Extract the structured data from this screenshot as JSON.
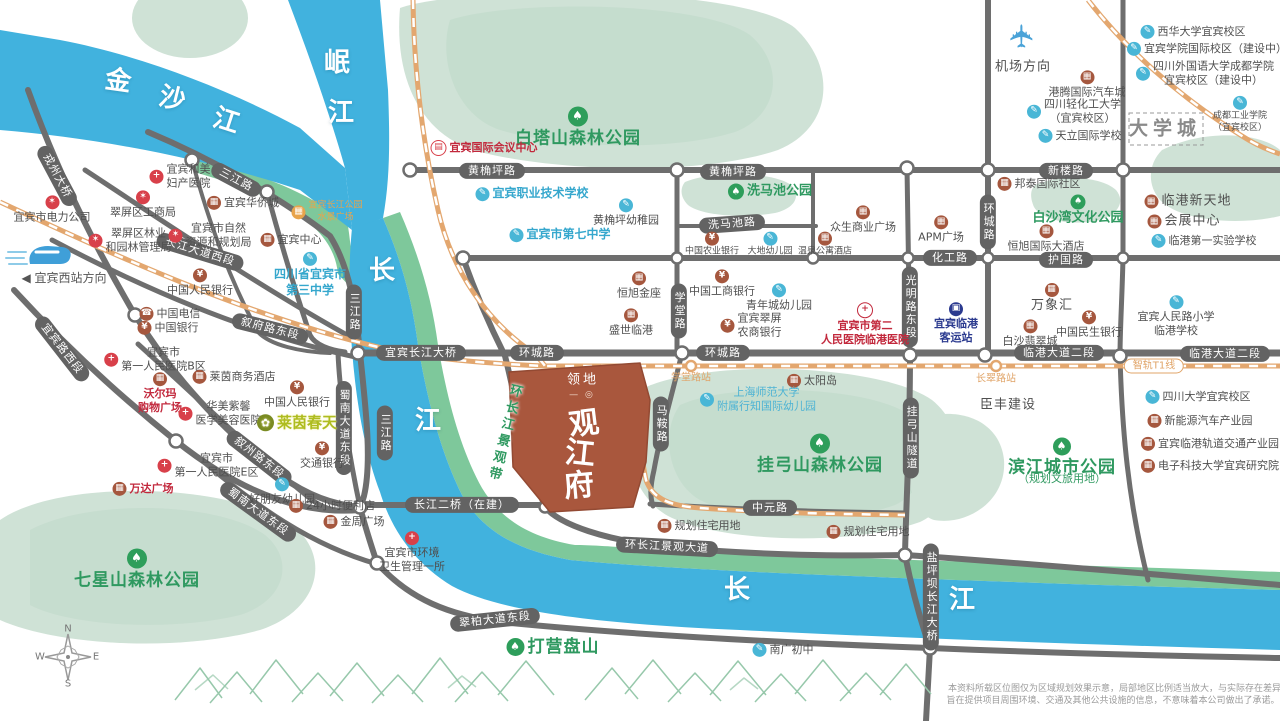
{
  "map": {
    "colors": {
      "river": "#41b2de",
      "river_bank": "#7ec89b",
      "hill": "#cfe2d6",
      "road": "#6e6e6e",
      "railway": "#e3a76f",
      "property": "#a9573d",
      "park_text": "#2f9960",
      "school_text": "#35a7cd",
      "hospital_red": "#c2283c"
    },
    "icon_styles": {
      "tree": {
        "glyph": "♠",
        "bg": "#2e9e5b"
      },
      "school": {
        "glyph": "✎",
        "bg": "#49b6d6"
      },
      "hospital": {
        "glyph": "+",
        "bg": "#d8404a"
      },
      "hosp2": {
        "glyph": "+",
        "bg": "#c2283c",
        "outline": true
      },
      "bank": {
        "glyph": "¥",
        "bg": "#a5573e"
      },
      "building": {
        "glyph": "▦",
        "bg": "#a5573e"
      },
      "gov": {
        "glyph": "✶",
        "bg": "#d8404a"
      },
      "bus": {
        "glyph": "▣",
        "bg": "#2b3a8f"
      },
      "phone": {
        "glyph": "☎",
        "bg": "#a5573e"
      },
      "orange": {
        "glyph": "▦",
        "bg": "#e8a44c"
      },
      "brand": {
        "glyph": "✿",
        "bg": "#7a8b22"
      },
      "conf": {
        "glyph": "▤",
        "bg": "#d8404a",
        "outline": true
      }
    },
    "labels": [
      {
        "t": "金",
        "x": 118,
        "y": 82,
        "c": "river",
        "r": 8
      },
      {
        "t": "沙",
        "x": 172,
        "y": 100,
        "c": "river",
        "r": 14
      },
      {
        "t": "江",
        "x": 226,
        "y": 122,
        "c": "river",
        "r": 18
      },
      {
        "t": "岷",
        "x": 337,
        "y": 64,
        "c": "river"
      },
      {
        "t": "江",
        "x": 341,
        "y": 114,
        "c": "river"
      },
      {
        "t": "长",
        "x": 382,
        "y": 272,
        "c": "river"
      },
      {
        "t": "江",
        "x": 428,
        "y": 422,
        "c": "river"
      },
      {
        "t": "长",
        "x": 737,
        "y": 591,
        "c": "river"
      },
      {
        "t": "江",
        "x": 962,
        "y": 601,
        "c": "river"
      },
      {
        "t": "黄桷坪路",
        "x": 492,
        "y": 171,
        "c": "pill"
      },
      {
        "t": "黄桷坪路",
        "x": 733,
        "y": 172,
        "c": "pill"
      },
      {
        "t": "新楼路",
        "x": 1066,
        "y": 171,
        "c": "pill"
      },
      {
        "t": "洗马池路",
        "x": 732,
        "y": 224,
        "c": "pill",
        "r": -4
      },
      {
        "t": "化工路",
        "x": 950,
        "y": 258,
        "c": "pill"
      },
      {
        "t": "护国路",
        "x": 1066,
        "y": 260,
        "c": "pill"
      },
      {
        "t": "环城路",
        "x": 537,
        "y": 353,
        "c": "pill"
      },
      {
        "t": "环城路",
        "x": 723,
        "y": 353,
        "c": "pill"
      },
      {
        "t": "环城路",
        "x": 988,
        "y": 222,
        "c": "pill",
        "v": 1
      },
      {
        "t": "学堂路",
        "x": 679,
        "y": 311,
        "c": "pill",
        "v": 1
      },
      {
        "t": "光明路东段",
        "x": 910,
        "y": 307,
        "c": "pill",
        "v": 1
      },
      {
        "t": "马鞍路",
        "x": 661,
        "y": 424,
        "c": "pill",
        "v": 1
      },
      {
        "t": "挂弓山隧道",
        "x": 911,
        "y": 438,
        "c": "pill",
        "v": 1
      },
      {
        "t": "临港大道二段",
        "x": 1059,
        "y": 353,
        "c": "pill"
      },
      {
        "t": "临港大道二段",
        "x": 1225,
        "y": 354,
        "c": "pill"
      },
      {
        "t": "宜宾长江大桥",
        "x": 421,
        "y": 353,
        "c": "pill"
      },
      {
        "t": "长江二桥（在建）",
        "x": 462,
        "y": 505,
        "c": "pill"
      },
      {
        "t": "中元路",
        "x": 770,
        "y": 508,
        "c": "pill"
      },
      {
        "t": "环长江景观大道",
        "x": 667,
        "y": 547,
        "c": "pill",
        "r": 3
      },
      {
        "t": "三江路",
        "x": 236,
        "y": 180,
        "c": "pill",
        "r": 28
      },
      {
        "t": "三江路",
        "x": 354,
        "y": 312,
        "c": "pill",
        "v": 1
      },
      {
        "t": "三江路",
        "x": 385,
        "y": 433,
        "c": "pill",
        "v": 1
      },
      {
        "t": "戎州大桥",
        "x": 57,
        "y": 176,
        "c": "pill",
        "r": 62
      },
      {
        "t": "长江大道西段",
        "x": 200,
        "y": 252,
        "c": "pill",
        "r": 17
      },
      {
        "t": "叙府路东段",
        "x": 270,
        "y": 329,
        "c": "pill",
        "r": 14
      },
      {
        "t": "宜宾路西段",
        "x": 62,
        "y": 349,
        "c": "pill",
        "r": 52
      },
      {
        "t": "叙州路东段",
        "x": 259,
        "y": 458,
        "c": "pill",
        "r": 38
      },
      {
        "t": "蜀南大道东段",
        "x": 258,
        "y": 512,
        "c": "pill",
        "r": 36
      },
      {
        "t": "蜀南大道东段",
        "x": 344,
        "y": 428,
        "c": "pill",
        "v": 1
      },
      {
        "t": "翠柏大道东段",
        "x": 495,
        "y": 620,
        "c": "pill",
        "r": -6
      },
      {
        "t": "盐坪坝长江大桥",
        "x": 931,
        "y": 597,
        "c": "pill",
        "v": 1
      },
      {
        "t": "智轨T1线",
        "x": 1154,
        "y": 366,
        "c": "pill-orange"
      },
      {
        "t": "学堂路站",
        "x": 691,
        "y": 378,
        "c": "station"
      },
      {
        "t": "长翠路站",
        "x": 996,
        "y": 379,
        "c": "station"
      },
      {
        "t": "白塔山森林公园",
        "x": 578,
        "y": 128,
        "c": "park-lg",
        "i": "tree",
        "ip": "top",
        "is": 20
      },
      {
        "t": "洗马池公园",
        "x": 770,
        "y": 192,
        "c": "park",
        "i": "tree",
        "ip": "left",
        "is": 16
      },
      {
        "t": "挂弓山森林公园",
        "x": 820,
        "y": 455,
        "c": "park-lg",
        "i": "tree",
        "ip": "top",
        "is": 20
      },
      {
        "t": "七星山森林公园",
        "x": 137,
        "y": 570,
        "c": "park-lg",
        "i": "tree",
        "ip": "top",
        "is": 20
      },
      {
        "t": "白沙湾文化公园",
        "x": 1078,
        "y": 211,
        "c": "park",
        "i": "tree",
        "ip": "top",
        "is": 15
      },
      {
        "t": "滨江城市公园",
        "x": 1062,
        "y": 458,
        "c": "park-lg",
        "i": "tree",
        "ip": "top",
        "is": 18
      },
      {
        "t": "（规划文旅用地）",
        "x": 1062,
        "y": 479,
        "c": "park-sub"
      },
      {
        "t": "打营盘山",
        "x": 553,
        "y": 647,
        "c": "park-lg",
        "i": "tree",
        "ip": "left",
        "is": 18
      },
      {
        "t": "环长江景观带",
        "x": 503,
        "y": 433,
        "c": "ribbon",
        "r": 14
      },
      {
        "t": [
          "宜宾和美",
          "妇产医院"
        ],
        "x": 180,
        "y": 177,
        "c": "poi",
        "i": "hospital",
        "ip": "left"
      },
      {
        "t": "宜宾市电力公司",
        "x": 52,
        "y": 210,
        "c": "poi",
        "i": "gov",
        "ip": "top"
      },
      {
        "t": "翠屏区工商局",
        "x": 143,
        "y": 205,
        "c": "poi",
        "i": "gov",
        "ip": "top"
      },
      {
        "t": "宜宾华侨城",
        "x": 243,
        "y": 203,
        "c": "poi",
        "i": "building",
        "ip": "left"
      },
      {
        "t": [
          "宜宾长江公园",
          "水景广场"
        ],
        "x": 327,
        "y": 212,
        "c": "poi-orange-sm",
        "i": "orange",
        "ip": "left"
      },
      {
        "t": [
          "翠屏区林业",
          "和园林管理局"
        ],
        "x": 130,
        "y": 241,
        "c": "poi",
        "i": "gov",
        "ip": "left"
      },
      {
        "t": [
          "宜宾市自然",
          "资源和规划局"
        ],
        "x": 210,
        "y": 236,
        "c": "poi",
        "i": "gov",
        "ip": "left"
      },
      {
        "t": "宜宾中心",
        "x": 291,
        "y": 240,
        "c": "poi",
        "i": "building",
        "ip": "left"
      },
      {
        "t": [
          "四川省宜宾市",
          "第三中学"
        ],
        "x": 310,
        "y": 275,
        "c": "poi-blue",
        "i": "school",
        "ip": "top"
      },
      {
        "t": "◀ 宜宾西站方向",
        "x": 64,
        "y": 279,
        "c": "poi-dir"
      },
      {
        "t": "中国人民银行",
        "x": 200,
        "y": 283,
        "c": "poi",
        "i": "bank",
        "ip": "top"
      },
      {
        "t": "中国电信",
        "x": 170,
        "y": 314,
        "c": "poi",
        "i": "phone",
        "ip": "left"
      },
      {
        "t": "中国银行",
        "x": 168,
        "y": 328,
        "c": "poi",
        "i": "bank",
        "ip": "left"
      },
      {
        "t": [
          "宜宾市",
          "第一人民医院B区"
        ],
        "x": 155,
        "y": 360,
        "c": "poi",
        "i": "hospital",
        "ip": "left"
      },
      {
        "t": "莱茵商务酒店",
        "x": 234,
        "y": 377,
        "c": "poi",
        "i": "building",
        "ip": "left"
      },
      {
        "t": "中国人民银行",
        "x": 297,
        "y": 395,
        "c": "poi",
        "i": "bank",
        "ip": "top"
      },
      {
        "t": [
          "沃尔玛",
          "购物广场"
        ],
        "x": 160,
        "y": 394,
        "c": "poi-red",
        "i": "building",
        "ip": "top"
      },
      {
        "t": [
          "华美紫馨",
          "医学美容医院"
        ],
        "x": 220,
        "y": 414,
        "c": "poi",
        "i": "hospital",
        "ip": "left"
      },
      {
        "t": "莱茵春天",
        "x": 297,
        "y": 423,
        "c": "brand",
        "i": "brand",
        "ip": "left",
        "is": 17
      },
      {
        "t": "万达广场",
        "x": 143,
        "y": 489,
        "c": "poi-red",
        "i": "building",
        "ip": "left"
      },
      {
        "t": [
          "宜宾市",
          "第一人民医院E区"
        ],
        "x": 208,
        "y": 466,
        "c": "poi",
        "i": "hospital",
        "ip": "left"
      },
      {
        "t": "交通银行",
        "x": 322,
        "y": 456,
        "c": "poi",
        "i": "bank",
        "ip": "top"
      },
      {
        "t": "好朋友幼儿园",
        "x": 282,
        "y": 492,
        "c": "poi",
        "i": "school",
        "ip": "top"
      },
      {
        "t": "24小时便利店",
        "x": 332,
        "y": 506,
        "c": "poi",
        "i": "building",
        "ip": "left"
      },
      {
        "t": "金周广场",
        "x": 354,
        "y": 522,
        "c": "poi",
        "i": "building",
        "ip": "left"
      },
      {
        "t": [
          "宜宾市环境",
          "卫生管理一所"
        ],
        "x": 412,
        "y": 553,
        "c": "poi",
        "i": "hospital",
        "ip": "top"
      },
      {
        "t": "宜宾国际会议中心",
        "x": 484,
        "y": 148,
        "c": "poi-red",
        "i": "conf",
        "ip": "left"
      },
      {
        "t": "宜宾职业技术学校",
        "x": 532,
        "y": 194,
        "c": "poi-blue",
        "i": "school",
        "ip": "left"
      },
      {
        "t": "黄桷坪幼稚园",
        "x": 626,
        "y": 213,
        "c": "poi",
        "i": "school",
        "ip": "top"
      },
      {
        "t": "宜宾市第七中学",
        "x": 560,
        "y": 235,
        "c": "poi-blue",
        "i": "school",
        "ip": "left"
      },
      {
        "t": "恒旭金座",
        "x": 639,
        "y": 286,
        "c": "poi",
        "i": "building",
        "ip": "top"
      },
      {
        "t": "盛世临港",
        "x": 631,
        "y": 323,
        "c": "poi",
        "i": "building",
        "ip": "top"
      },
      {
        "t": "中国工商银行",
        "x": 722,
        "y": 284,
        "c": "poi",
        "i": "bank",
        "ip": "top"
      },
      {
        "t": "青年城幼儿园",
        "x": 779,
        "y": 298,
        "c": "poi",
        "i": "school",
        "ip": "top"
      },
      {
        "t": [
          "宜宾翠屏",
          "农商银行"
        ],
        "x": 751,
        "y": 326,
        "c": "poi",
        "i": "bank",
        "ip": "left"
      },
      {
        "t": [
          "宜宾市第二",
          "人民医院临港医院"
        ],
        "x": 865,
        "y": 325,
        "c": "poi-red",
        "i": "hosp2",
        "ip": "top"
      },
      {
        "t": "中国农业银行",
        "x": 712,
        "y": 245,
        "c": "poi-xs",
        "i": "bank",
        "ip": "top"
      },
      {
        "t": "大地幼儿园",
        "x": 770,
        "y": 245,
        "c": "poi-xs",
        "i": "school",
        "ip": "top"
      },
      {
        "t": "温泉公寓酒店",
        "x": 825,
        "y": 245,
        "c": "poi-xs",
        "i": "building",
        "ip": "top"
      },
      {
        "t": "众生商业广场",
        "x": 863,
        "y": 220,
        "c": "poi",
        "i": "building",
        "ip": "top"
      },
      {
        "t": "APM广场",
        "x": 941,
        "y": 230,
        "c": "poi",
        "i": "building",
        "ip": "top"
      },
      {
        "t": "邦泰国际社区",
        "x": 1039,
        "y": 184,
        "c": "poi",
        "i": "building",
        "ip": "left"
      },
      {
        "t": "恒旭国际大酒店",
        "x": 1046,
        "y": 239,
        "c": "poi",
        "i": "building",
        "ip": "top"
      },
      {
        "t": "临港新天地",
        "x": 1188,
        "y": 202,
        "c": "poi-md",
        "i": "building",
        "ip": "left"
      },
      {
        "t": "会展中心",
        "x": 1184,
        "y": 222,
        "c": "poi-md",
        "i": "building",
        "ip": "left"
      },
      {
        "t": "临港第一实验学校",
        "x": 1204,
        "y": 241,
        "c": "poi",
        "i": "school",
        "ip": "left"
      },
      {
        "t": "万象汇",
        "x": 1052,
        "y": 299,
        "c": "poi-md",
        "i": "building",
        "ip": "top"
      },
      {
        "t": "白沙翡翠城",
        "x": 1030,
        "y": 334,
        "c": "poi",
        "i": "building",
        "ip": "top"
      },
      {
        "t": "中国民生银行",
        "x": 1089,
        "y": 325,
        "c": "poi",
        "i": "bank",
        "ip": "top"
      },
      {
        "t": [
          "宜宾临港",
          "客运站"
        ],
        "x": 956,
        "y": 324,
        "c": "poi-navy",
        "i": "bus",
        "ip": "top"
      },
      {
        "t": [
          "宜宾人民路小学",
          "临港学校"
        ],
        "x": 1176,
        "y": 317,
        "c": "poi",
        "i": "school",
        "ip": "top"
      },
      {
        "t": "太阳岛",
        "x": 812,
        "y": 381,
        "c": "poi",
        "i": "building",
        "ip": "left"
      },
      {
        "t": [
          "上海师范大学",
          "附属行知国际幼儿园"
        ],
        "x": 758,
        "y": 400,
        "c": "poi-blue2",
        "i": "school",
        "ip": "left"
      },
      {
        "t": "臣丰建设",
        "x": 1008,
        "y": 406,
        "c": "poi-md"
      },
      {
        "t": "规划住宅用地",
        "x": 699,
        "y": 526,
        "c": "poi",
        "i": "building",
        "ip": "left"
      },
      {
        "t": "规划住宅用地",
        "x": 868,
        "y": 532,
        "c": "poi",
        "i": "building",
        "ip": "left"
      },
      {
        "t": "机场方向",
        "x": 1023,
        "y": 68,
        "c": "poi-md"
      },
      {
        "t": "✈",
        "x": 1023,
        "y": 36,
        "c": "plane",
        "r": -90,
        "n": "airplane-icon"
      },
      {
        "t": "港腾国际汽车城",
        "x": 1087,
        "y": 85,
        "c": "poi",
        "i": "building",
        "ip": "top"
      },
      {
        "t": [
          "四川轻化工大学",
          "（宜宾校区）"
        ],
        "x": 1074,
        "y": 112,
        "c": "poi",
        "i": "school",
        "ip": "left"
      },
      {
        "t": "天立国际学校",
        "x": 1080,
        "y": 136,
        "c": "poi",
        "i": "school",
        "ip": "left"
      },
      {
        "t": "西华大学宜宾校区",
        "x": 1193,
        "y": 32,
        "c": "poi",
        "i": "school",
        "ip": "left"
      },
      {
        "t": "宜宾学院国际校区（建设中）",
        "x": 1207,
        "y": 49,
        "c": "poi",
        "i": "school",
        "ip": "left"
      },
      {
        "t": [
          "四川外国语大学成都学院",
          "宜宾校区（建设中）"
        ],
        "x": 1205,
        "y": 74,
        "c": "poi",
        "i": "school",
        "ip": "left"
      },
      {
        "t": [
          "成都工业学院",
          "（宜宾校区）"
        ],
        "x": 1240,
        "y": 115,
        "c": "poi-xs",
        "i": "school",
        "ip": "top"
      },
      {
        "t": "大学城",
        "x": 1165,
        "y": 129,
        "c": "uni-town"
      },
      {
        "t": "四川大学宜宾校区",
        "x": 1198,
        "y": 397,
        "c": "poi",
        "i": "school",
        "ip": "left"
      },
      {
        "t": "新能源汽车产业园",
        "x": 1200,
        "y": 421,
        "c": "poi",
        "i": "building",
        "ip": "left"
      },
      {
        "t": "宜宾临港轨道交通产业园",
        "x": 1210,
        "y": 444,
        "c": "poi",
        "i": "building",
        "ip": "left"
      },
      {
        "t": "电子科技大学宜宾研究院",
        "x": 1210,
        "y": 466,
        "c": "poi",
        "i": "building",
        "ip": "left"
      },
      {
        "t": "南广初中",
        "x": 783,
        "y": 650,
        "c": "poi",
        "i": "school",
        "ip": "left"
      },
      {
        "t": "领地",
        "x": 583,
        "y": 381,
        "c": "prop-brand",
        "n": "property-brand"
      },
      {
        "t": "— ◎",
        "x": 582,
        "y": 396,
        "c": "prop-logo",
        "n": "property-logo"
      },
      {
        "t": "观",
        "x": 584,
        "y": 424,
        "c": "prop-char",
        "r": -7,
        "n": "property-name-char"
      },
      {
        "t": "江",
        "x": 580,
        "y": 454,
        "c": "prop-char",
        "r": 6,
        "n": "property-name-char"
      },
      {
        "t": "府",
        "x": 579,
        "y": 486,
        "c": "prop-char",
        "r": -5,
        "n": "property-name-char"
      },
      {
        "t": "N",
        "x": 68,
        "y": 629,
        "c": "cmp",
        "n": "compass-letter-n"
      },
      {
        "t": "W",
        "x": 40,
        "y": 657,
        "c": "cmp",
        "n": "compass-letter-w"
      },
      {
        "t": "E",
        "x": 96,
        "y": 657,
        "c": "cmp",
        "n": "compass-letter-e"
      },
      {
        "t": "S",
        "x": 68,
        "y": 684,
        "c": "cmp",
        "n": "compass-letter-s"
      },
      {
        "t": "本资料所载区位图仅为区域规划效果示意，局部地区比例适当放大，与实际存在差异，",
        "x": 1119,
        "y": 690,
        "c": "disc",
        "n": "disclaimer-line"
      },
      {
        "t": "旨在提供项目周围环境、交通及其他公共设施的信息，不意味着本公司做出了承诺。",
        "x": 1113,
        "y": 702,
        "c": "disc",
        "n": "disclaimer-line"
      }
    ]
  }
}
